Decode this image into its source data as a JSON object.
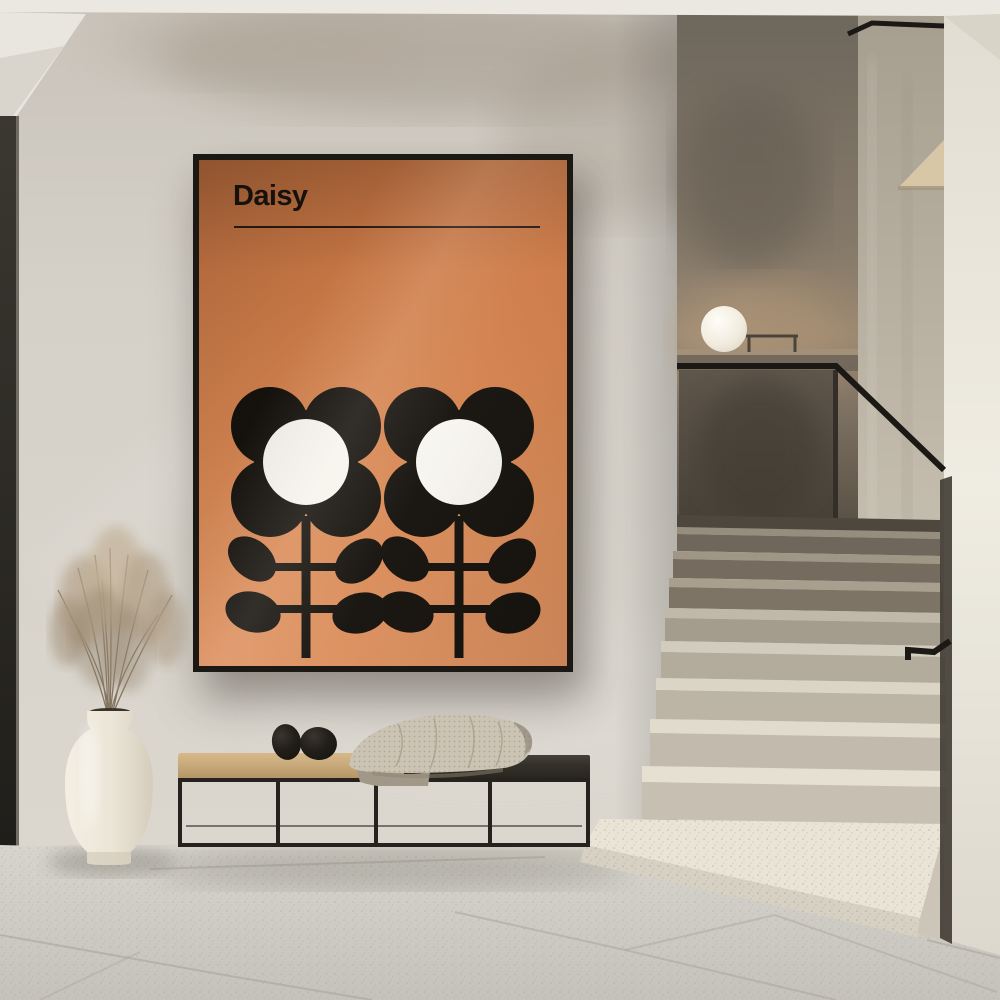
{
  "scene": {
    "type": "interior-photograph",
    "description": "Minimalist concrete hallway with a framed Daisy art print, black metal bench with cushion, waffle blanket and two black stones, cream vase with dried grass, sphere lamp on stair parapet, and a terrazzo staircase with smoked-glass balustrade and black handrail",
    "objects": [
      "daisy-poster",
      "bench",
      "waffle-blanket",
      "decor-stones",
      "ceramic-vase",
      "dried-grass",
      "sphere-lamp",
      "terrazzo-staircase",
      "glass-balustrade",
      "black-handrail",
      "tile-floor"
    ]
  },
  "poster": {
    "title": "Daisy",
    "flower_count": 2,
    "bg_color": "#d4824e",
    "ink_color": "#14110d",
    "flower_center_color": "#f7f5f0",
    "frame_color": "#1c1915"
  },
  "palette": {
    "wall": "#d5d1c9",
    "ceiling": "#eae8e1",
    "soffit": "#e8e6df",
    "door-edge": "#34312a",
    "recess-top": "#6e675c",
    "recess-warm": "#9d8a74",
    "glass": "#554d43",
    "rail": "#1b1815",
    "ledge": "#a29079",
    "inner-wall": "#bdb5a6",
    "outer-wall": "#eae6dc",
    "wedge": "#d8c7a7",
    "groove": "#433e36",
    "floor": "#d0cdc6",
    "grout": "#a9a59c",
    "step-light-tread": "#e5dfd2",
    "step-light-riser": "#c7c0b2",
    "step-dark-tread": "#9d9485",
    "step-dark-riser": "#756c5f",
    "poster-bg": "#d4824e",
    "poster-ink": "#14110d",
    "poster-white": "#f7f5f0",
    "poster-frame": "#1c1915",
    "bench-cushion": "#c9aa7b",
    "bench-seat": "#34302a",
    "bench-frame": "#26231e",
    "blanket": "#cbc3b3",
    "blanket-shade": "#a2988a",
    "stone": "#1f1c18",
    "vase": "#ece6d9",
    "plant": "#b2a087",
    "lamp": "#f4f1e9"
  }
}
